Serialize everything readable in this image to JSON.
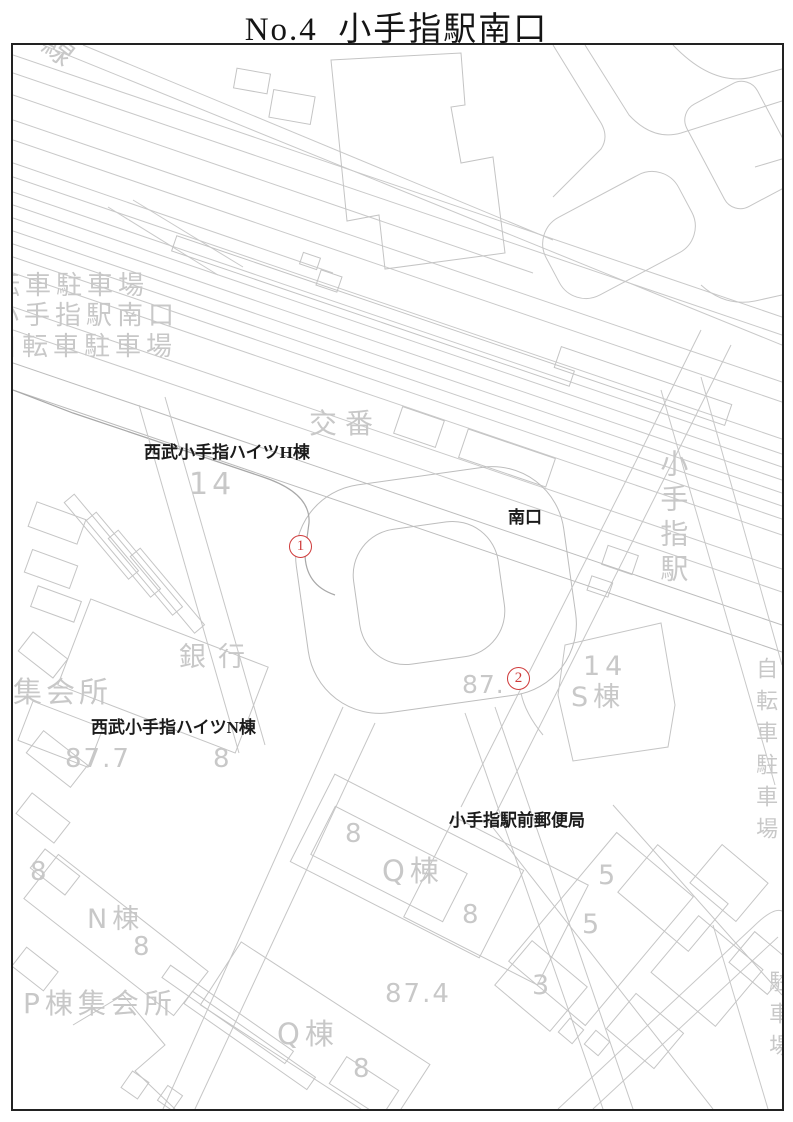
{
  "title": "No.4  小手指駅南口",
  "colors": {
    "line": "#c9c9c9",
    "line_dark": "#a8a8a8",
    "gray_text": "#c8c8c8",
    "black_text": "#1b1b1b",
    "marker_red": "#cf3a3a",
    "border": "#222222"
  },
  "map": {
    "black_labels": [
      {
        "text": "西武小手指ハイツH棟",
        "x": 131,
        "y": 399,
        "size": 17
      },
      {
        "text": "南口",
        "x": 495,
        "y": 464,
        "size": 17
      },
      {
        "text": "西武小手指ハイツN棟",
        "x": 78,
        "y": 674,
        "size": 17
      },
      {
        "text": "小手指駅前郵便局",
        "x": 436,
        "y": 767,
        "size": 17
      }
    ],
    "gray_labels": [
      {
        "text": "自転車駐車場",
        "x": -50,
        "y": 228,
        "size": 26,
        "ls": 5
      },
      {
        "text": "小手指駅南口",
        "x": -20,
        "y": 258,
        "size": 26,
        "ls": 5
      },
      {
        "text": "自転車駐車場",
        "x": -22,
        "y": 289,
        "size": 26,
        "ls": 5
      },
      {
        "text": "交番",
        "x": 296,
        "y": 364,
        "size": 28,
        "ls": 8
      },
      {
        "text": "14",
        "x": 176,
        "y": 424,
        "size": 30,
        "ls": 4
      },
      {
        "text": "銀行",
        "x": 166,
        "y": 599,
        "size": 27,
        "ls": 12
      },
      {
        "text": "集会所",
        "x": 0,
        "y": 632,
        "size": 29,
        "ls": 4
      },
      {
        "text": "87.7",
        "x": 52,
        "y": 701,
        "size": 26,
        "ls": 2
      },
      {
        "text": "8",
        "x": 200,
        "y": 701,
        "size": 26,
        "ls": 0
      },
      {
        "text": "87.",
        "x": 449,
        "y": 627,
        "size": 25,
        "ls": 1
      },
      {
        "text": "14",
        "x": 570,
        "y": 608,
        "size": 27,
        "ls": 5
      },
      {
        "text": "S棟",
        "x": 558,
        "y": 639,
        "size": 27,
        "ls": 5
      },
      {
        "text": "8",
        "x": 332,
        "y": 776,
        "size": 26,
        "ls": 0
      },
      {
        "text": "Q棟",
        "x": 369,
        "y": 811,
        "size": 29,
        "ls": 5
      },
      {
        "text": "8",
        "x": 449,
        "y": 857,
        "size": 26,
        "ls": 0
      },
      {
        "text": "5",
        "x": 585,
        "y": 817,
        "size": 27,
        "ls": 0
      },
      {
        "text": "5",
        "x": 569,
        "y": 866,
        "size": 27,
        "ls": 0
      },
      {
        "text": "3",
        "x": 519,
        "y": 927,
        "size": 27,
        "ls": 0
      },
      {
        "text": "8",
        "x": 17,
        "y": 814,
        "size": 26,
        "ls": 0
      },
      {
        "text": "N棟",
        "x": 74,
        "y": 861,
        "size": 27,
        "ls": 5
      },
      {
        "text": "8",
        "x": 120,
        "y": 889,
        "size": 26,
        "ls": 0
      },
      {
        "text": "P棟集会所",
        "x": 10,
        "y": 944,
        "size": 28,
        "ls": 5
      },
      {
        "text": "Q棟",
        "x": 264,
        "y": 974,
        "size": 29,
        "ls": 5
      },
      {
        "text": "8",
        "x": 340,
        "y": 1011,
        "size": 26,
        "ls": 0
      },
      {
        "text": "87.4",
        "x": 372,
        "y": 936,
        "size": 26,
        "ls": 2
      }
    ],
    "vertical_labels": [
      {
        "text": "小手指駅",
        "x": 645,
        "y": 404,
        "size": 28,
        "ls": 7
      },
      {
        "text": "自転車駐車場",
        "x": 740,
        "y": 612,
        "size": 22,
        "ls": 10
      },
      {
        "text": "駐車場",
        "x": 753,
        "y": 925,
        "size": 22,
        "ls": 10
      }
    ],
    "rotated_labels": [
      {
        "text": "線",
        "x": 30,
        "y": -10,
        "size": 30,
        "rot": 38
      }
    ],
    "markers": [
      {
        "label": "1",
        "cx": 287,
        "cy": 501
      },
      {
        "label": "2",
        "cx": 505,
        "cy": 633
      }
    ]
  }
}
